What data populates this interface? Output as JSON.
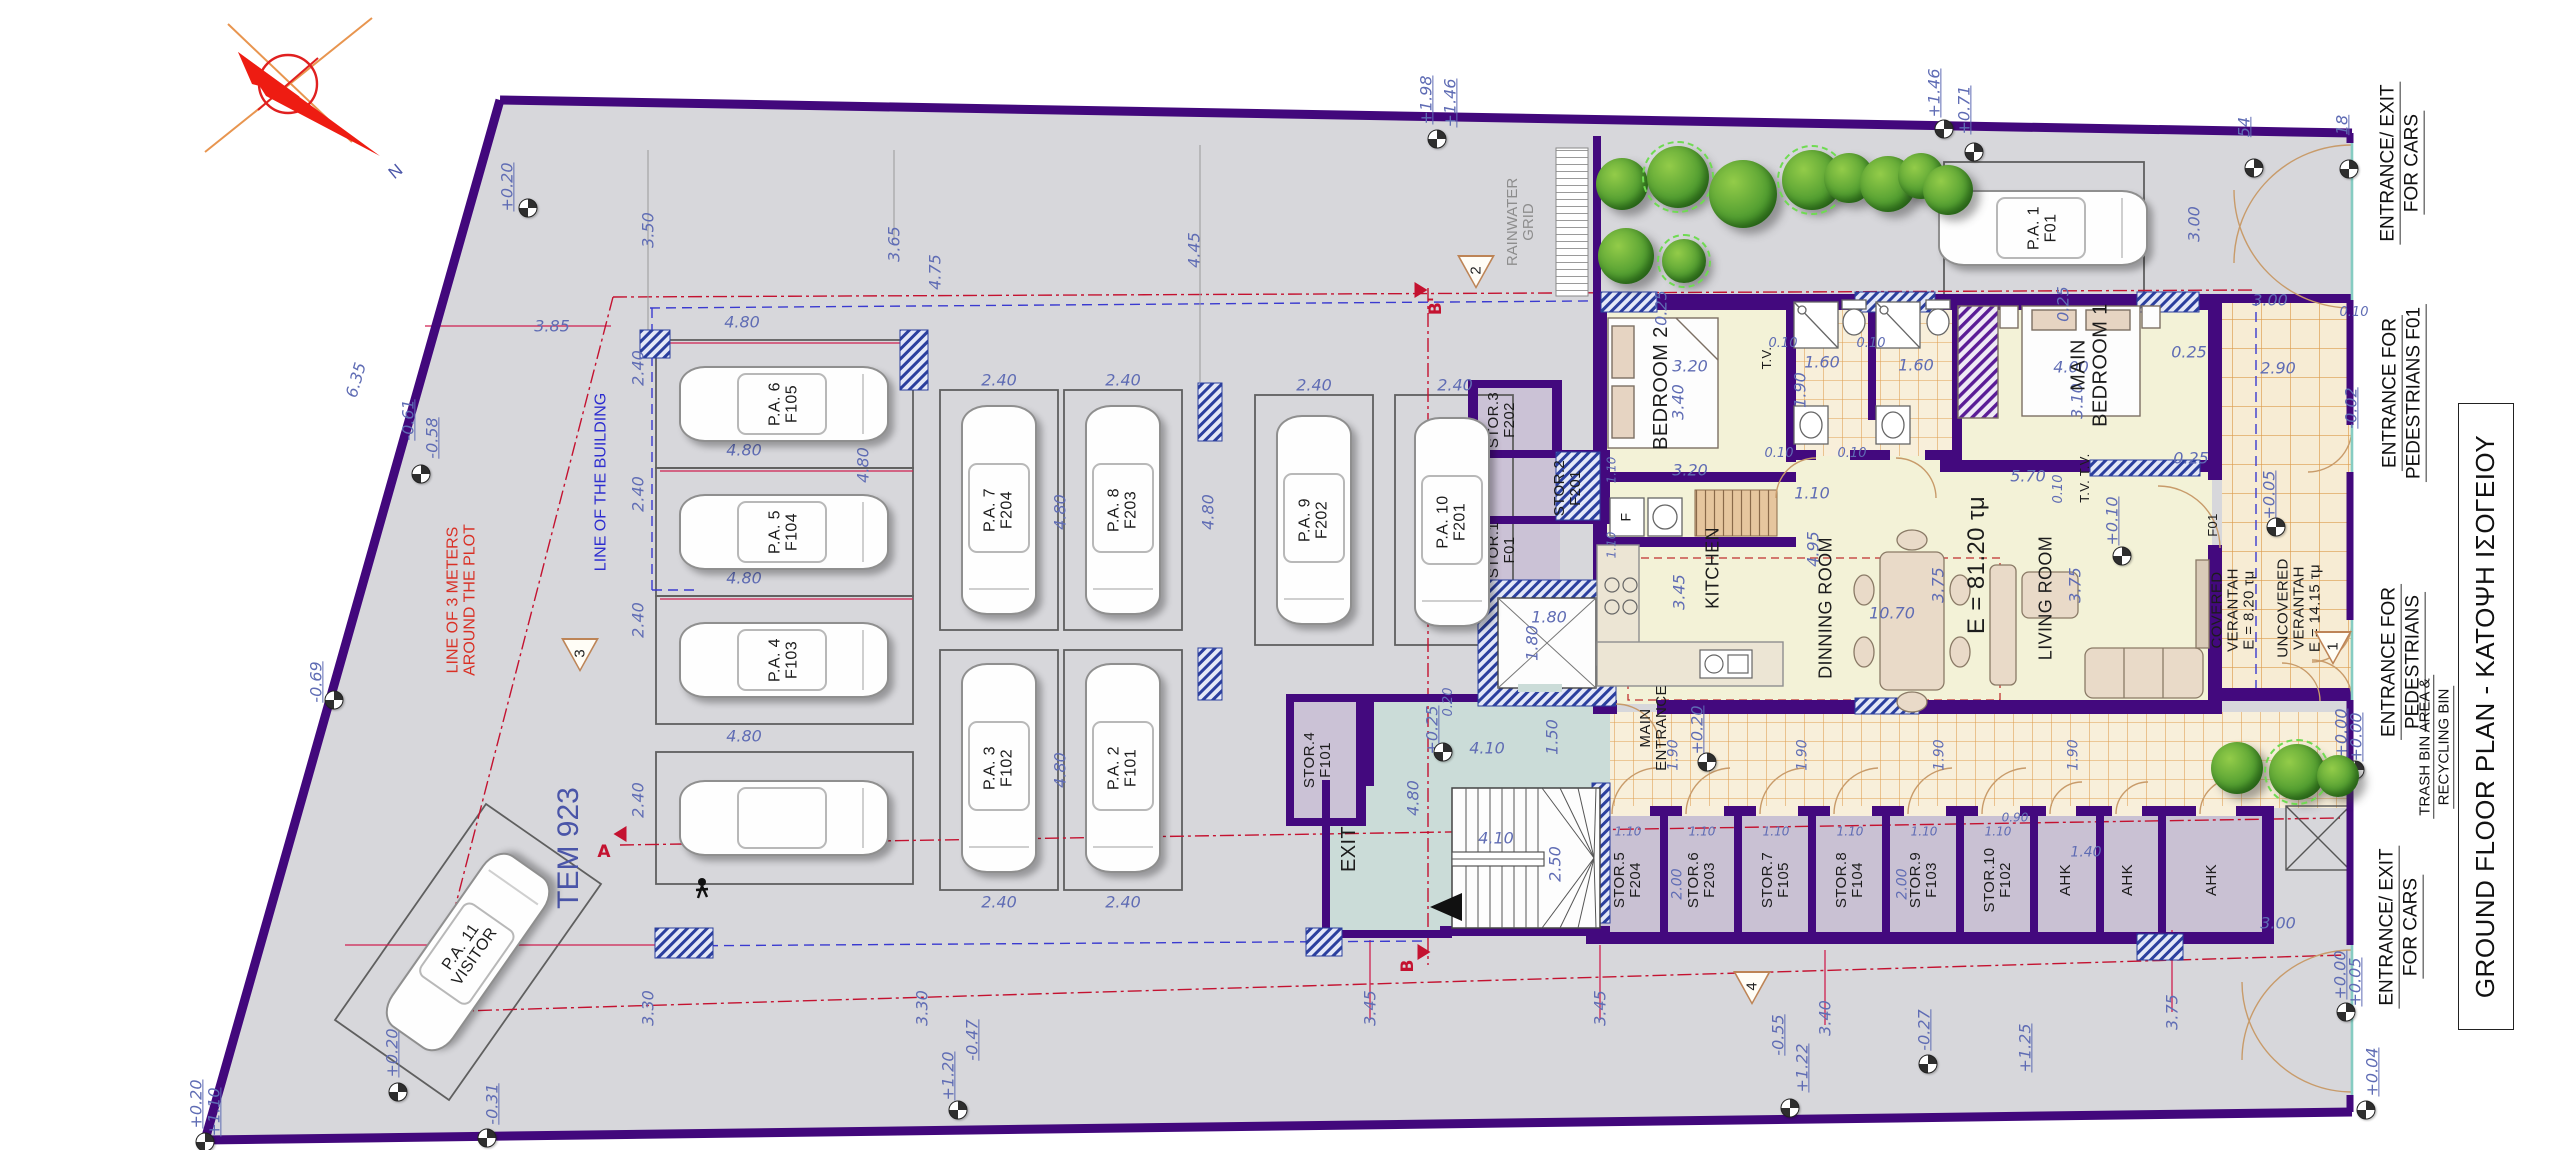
{
  "meta": {
    "title": "GROUND FLOOR PLAN - ΚΑΤΟΨΗ ΙΣΟΓΕΙΟΥ",
    "north_label": "N",
    "plot_id": "TEM 923"
  },
  "notes": {
    "plot_offset": "LINE OF 3 METERS\nAROUND THE PLOT",
    "building_line": "LINE OF THE BUILDING",
    "rainwater": "RAINWATER\nGRID"
  },
  "right_labels": [
    {
      "line1": "ENTRANCE/ EXIT",
      "line2": "FOR CARS"
    },
    {
      "line1": "ENTRANCE FOR",
      "line2": "PEDESTRIANS F01"
    },
    {
      "line1": "ENTRANCE FOR",
      "line2": "PEDESTRIANS"
    },
    {
      "line1": "TRASH BIN AREA &",
      "line2": "RECYCLING BIN"
    },
    {
      "line1": "ENTRANCE/ EXIT",
      "line2": "FOR CARS"
    }
  ],
  "rooms": [
    {
      "t": "BEDROOM 2",
      "x": 1662,
      "y": 388,
      "r": -90,
      "s": 20
    },
    {
      "t": "MAIN\nBEDROOM 1",
      "x": 2090,
      "y": 365,
      "r": -90,
      "s": 20
    },
    {
      "t": "KITCHEN",
      "x": 1713,
      "y": 568,
      "r": -90,
      "s": 18
    },
    {
      "t": "DINNING ROOM",
      "x": 1826,
      "y": 608,
      "r": -90,
      "s": 18
    },
    {
      "t": "LIVING ROOM",
      "x": 2046,
      "y": 598,
      "r": -90,
      "s": 18
    },
    {
      "t": "E = 81.20 τμ",
      "x": 1977,
      "y": 565,
      "r": -90,
      "s": 24
    },
    {
      "t": "MAIN\nENTRANCE",
      "x": 1654,
      "y": 728,
      "r": -90,
      "s": 15
    },
    {
      "t": "COVERED\nVERANTAH\nE = 8.20 τμ",
      "x": 2234,
      "y": 610,
      "r": -90,
      "s": 15
    },
    {
      "t": "UNCOVERED\nVERANTAH\nE = 14.15 τμ",
      "x": 2300,
      "y": 608,
      "r": -90,
      "s": 15
    },
    {
      "t": "T.V.",
      "x": 1767,
      "y": 358,
      "r": -90,
      "s": 13
    },
    {
      "t": "T.V. T.V.",
      "x": 2085,
      "y": 478,
      "r": -90,
      "s": 13
    },
    {
      "t": "F",
      "x": 1626,
      "y": 517,
      "r": -90,
      "s": 14
    },
    {
      "t": "F01",
      "x": 2213,
      "y": 525,
      "r": -90,
      "s": 13
    },
    {
      "t": "EXIT",
      "x": 1350,
      "y": 849,
      "r": -90,
      "s": 20
    }
  ],
  "storage": [
    {
      "t": "STOR.5\nF204",
      "x": 1628,
      "y": 880
    },
    {
      "t": "STOR.6\nF203",
      "x": 1702,
      "y": 880
    },
    {
      "t": "STOR.7\nF105",
      "x": 1776,
      "y": 880
    },
    {
      "t": "STOR.8\nF104",
      "x": 1850,
      "y": 880
    },
    {
      "t": "STOR.9\nF103",
      "x": 1924,
      "y": 880
    },
    {
      "t": "STOR.10\nF102",
      "x": 1998,
      "y": 880
    },
    {
      "t": "AHK",
      "x": 2066,
      "y": 880
    },
    {
      "t": "AHK",
      "x": 2128,
      "y": 880
    },
    {
      "t": "AHK",
      "x": 2212,
      "y": 880
    },
    {
      "t": "STOR.4\nF101",
      "x": 1318,
      "y": 760
    },
    {
      "t": "STOR.3\nF202",
      "x": 1502,
      "y": 420
    },
    {
      "t": "STOR.2\nF201",
      "x": 1568,
      "y": 488
    },
    {
      "t": "STOR.1\nF01",
      "x": 1502,
      "y": 550
    }
  ],
  "parking": [
    {
      "t": "P.A. 6\nF105",
      "cx": 784,
      "cy": 404,
      "o": "h"
    },
    {
      "t": "P.A. 5\nF104",
      "cx": 784,
      "cy": 532,
      "o": "h"
    },
    {
      "t": "P.A. 4\nF103",
      "cx": 784,
      "cy": 660,
      "o": "h"
    },
    {
      "t": "",
      "cx": 784,
      "cy": 818,
      "o": "h"
    },
    {
      "t": "P.A. 7\nF204",
      "cx": 999,
      "cy": 510,
      "o": "v"
    },
    {
      "t": "P.A. 8\nF203",
      "cx": 1123,
      "cy": 510,
      "o": "v"
    },
    {
      "t": "P.A. 3\nF102",
      "cx": 999,
      "cy": 768,
      "o": "v"
    },
    {
      "t": "P.A. 2\nF101",
      "cx": 1123,
      "cy": 768,
      "o": "v"
    },
    {
      "t": "P.A. 9\nF202",
      "cx": 1314,
      "cy": 520,
      "o": "v"
    },
    {
      "t": "P.A. 10\nF201",
      "cx": 1452,
      "cy": 522,
      "o": "v"
    },
    {
      "t": "P.A. 1\nF01",
      "cx": 2043,
      "cy": 228,
      "o": "h"
    },
    {
      "t": "P.A. 11\nVISITOR",
      "cx": 468,
      "cy": 952,
      "o": "h",
      "cr": -55,
      "lr": -55
    }
  ],
  "dimensions": [
    {
      "t": "3.50",
      "x": 648,
      "y": 230,
      "r": -90
    },
    {
      "t": "3.65",
      "x": 894,
      "y": 244,
      "r": -90
    },
    {
      "t": "4.75",
      "x": 935,
      "y": 272,
      "r": -90
    },
    {
      "t": "3.85",
      "x": 552,
      "y": 326,
      "r": 0
    },
    {
      "t": "4.45",
      "x": 1194,
      "y": 250,
      "r": -90
    },
    {
      "t": "6.35",
      "x": 356,
      "y": 380,
      "r": -74
    },
    {
      "t": "4.80",
      "x": 742,
      "y": 322,
      "r": 0
    },
    {
      "t": "4.80",
      "x": 744,
      "y": 450,
      "r": 0
    },
    {
      "t": "4.80",
      "x": 744,
      "y": 578,
      "r": 0
    },
    {
      "t": "4.80",
      "x": 744,
      "y": 736,
      "r": 0
    },
    {
      "t": "4.80",
      "x": 863,
      "y": 465,
      "r": -90
    },
    {
      "t": "2.40",
      "x": 638,
      "y": 368,
      "r": -90
    },
    {
      "t": "2.40",
      "x": 638,
      "y": 494,
      "r": -90
    },
    {
      "t": "2.40",
      "x": 638,
      "y": 620,
      "r": -90
    },
    {
      "t": "2.40",
      "x": 638,
      "y": 800,
      "r": -90
    },
    {
      "t": "2.40",
      "x": 999,
      "y": 380,
      "r": 0
    },
    {
      "t": "2.40",
      "x": 1123,
      "y": 380,
      "r": 0
    },
    {
      "t": "2.40",
      "x": 1314,
      "y": 385,
      "r": 0
    },
    {
      "t": "2.40",
      "x": 1455,
      "y": 385,
      "r": 0
    },
    {
      "t": "4.80",
      "x": 1060,
      "y": 512,
      "r": -90
    },
    {
      "t": "4.80",
      "x": 1208,
      "y": 512,
      "r": -90
    },
    {
      "t": "4.80",
      "x": 1332,
      "y": 512,
      "r": -90
    },
    {
      "t": "2.40",
      "x": 999,
      "y": 902,
      "r": 0
    },
    {
      "t": "2.40",
      "x": 1123,
      "y": 902,
      "r": 0
    },
    {
      "t": "4.80",
      "x": 1060,
      "y": 770,
      "r": -90
    },
    {
      "t": "7.50",
      "x": 460,
      "y": 945,
      "r": 0
    },
    {
      "t": "3.20",
      "x": 1690,
      "y": 366,
      "r": 0
    },
    {
      "t": "3.40",
      "x": 1678,
      "y": 402,
      "r": -90
    },
    {
      "t": "3.20",
      "x": 1690,
      "y": 470,
      "r": 0
    },
    {
      "t": "0.25",
      "x": 1661,
      "y": 308,
      "r": -90
    },
    {
      "t": "0.25",
      "x": 2063,
      "y": 304,
      "r": -90
    },
    {
      "t": "0.25",
      "x": 2189,
      "y": 352,
      "r": 0
    },
    {
      "t": "0.25",
      "x": 2191,
      "y": 458,
      "r": 0
    },
    {
      "t": "4.00",
      "x": 2071,
      "y": 367,
      "r": 0
    },
    {
      "t": "3.10",
      "x": 2077,
      "y": 401,
      "r": -90
    },
    {
      "t": "1.60",
      "x": 1822,
      "y": 362,
      "r": 0
    },
    {
      "t": "1.60",
      "x": 1916,
      "y": 365,
      "r": 0
    },
    {
      "t": "1.90",
      "x": 1800,
      "y": 390,
      "r": -90
    },
    {
      "t": "0.10",
      "x": 1783,
      "y": 344,
      "r": 0,
      "s": 13
    },
    {
      "t": "0.10",
      "x": 1871,
      "y": 344,
      "r": 0,
      "s": 13
    },
    {
      "t": "0.10",
      "x": 1779,
      "y": 454,
      "r": 0,
      "s": 13
    },
    {
      "t": "0.10",
      "x": 1852,
      "y": 454,
      "r": 0,
      "s": 13
    },
    {
      "t": "1.10",
      "x": 1812,
      "y": 493,
      "r": 0
    },
    {
      "t": "5.70",
      "x": 2028,
      "y": 476,
      "r": 0
    },
    {
      "t": "0.10",
      "x": 2059,
      "y": 489,
      "r": -90,
      "s": 13
    },
    {
      "t": "3.45",
      "x": 1679,
      "y": 592,
      "r": -90
    },
    {
      "t": "4.95",
      "x": 1813,
      "y": 549,
      "r": -90
    },
    {
      "t": "10.70",
      "x": 1892,
      "y": 613,
      "r": 0
    },
    {
      "t": "3.75",
      "x": 1938,
      "y": 585,
      "r": -90
    },
    {
      "t": "3.75",
      "x": 2075,
      "y": 585,
      "r": -90
    },
    {
      "t": "2.90",
      "x": 2278,
      "y": 368,
      "r": 0
    },
    {
      "t": "3.00",
      "x": 2270,
      "y": 300,
      "r": 0
    },
    {
      "t": "3.00",
      "x": 2194,
      "y": 224,
      "r": -90
    },
    {
      "t": "3.00",
      "x": 2278,
      "y": 923,
      "r": 0
    },
    {
      "t": "1.80",
      "x": 1549,
      "y": 617,
      "r": 0
    },
    {
      "t": "1.80",
      "x": 1532,
      "y": 643,
      "r": -90
    },
    {
      "t": "1.50",
      "x": 1552,
      "y": 737,
      "r": -90
    },
    {
      "t": "4.10",
      "x": 1487,
      "y": 748,
      "r": 0
    },
    {
      "t": "4.10",
      "x": 1496,
      "y": 838,
      "r": 0
    },
    {
      "t": "4.80",
      "x": 1413,
      "y": 798,
      "r": -90
    },
    {
      "t": "2.50",
      "x": 1555,
      "y": 864,
      "r": -90
    },
    {
      "t": "0.20",
      "x": 1449,
      "y": 702,
      "r": -90,
      "s": 13
    },
    {
      "t": "1.90",
      "x": 1674,
      "y": 755,
      "r": -90,
      "s": 14
    },
    {
      "t": "1.90",
      "x": 1803,
      "y": 755,
      "r": -90,
      "s": 14
    },
    {
      "t": "1.90",
      "x": 1940,
      "y": 755,
      "r": -90,
      "s": 14
    },
    {
      "t": "1.90",
      "x": 2074,
      "y": 755,
      "r": -90,
      "s": 14
    },
    {
      "t": "1.10",
      "x": 1628,
      "y": 832,
      "r": 0,
      "s": 12
    },
    {
      "t": "1.10",
      "x": 1702,
      "y": 832,
      "r": 0,
      "s": 12
    },
    {
      "t": "1.10",
      "x": 1776,
      "y": 832,
      "r": 0,
      "s": 12
    },
    {
      "t": "1.10",
      "x": 1850,
      "y": 832,
      "r": 0,
      "s": 12
    },
    {
      "t": "1.10",
      "x": 1924,
      "y": 832,
      "r": 0,
      "s": 12
    },
    {
      "t": "1.10",
      "x": 1998,
      "y": 832,
      "r": 0,
      "s": 12
    },
    {
      "t": "0.90",
      "x": 2015,
      "y": 818,
      "r": 0,
      "s": 12
    },
    {
      "t": "1.40",
      "x": 2086,
      "y": 853,
      "r": 0,
      "s": 14
    },
    {
      "t": "2.00",
      "x": 1678,
      "y": 884,
      "r": -90,
      "s": 14
    },
    {
      "t": "2.00",
      "x": 1903,
      "y": 884,
      "r": -90,
      "s": 14
    },
    {
      "t": "1.10",
      "x": 1612,
      "y": 470,
      "r": -90,
      "s": 12
    },
    {
      "t": "1.10",
      "x": 1612,
      "y": 545,
      "r": -90,
      "s": 12
    },
    {
      "t": "0.10",
      "x": 2354,
      "y": 313,
      "r": 0,
      "s": 13
    },
    {
      "t": "3.30",
      "x": 648,
      "y": 1008,
      "r": -90
    },
    {
      "t": "3.30",
      "x": 922,
      "y": 1008,
      "r": -90
    },
    {
      "t": "3.45",
      "x": 1370,
      "y": 1008,
      "r": -90
    },
    {
      "t": "3.45",
      "x": 1600,
      "y": 1008,
      "r": -90
    },
    {
      "t": "3.40",
      "x": 1825,
      "y": 1018,
      "r": -90
    },
    {
      "t": "3.75",
      "x": 2172,
      "y": 1012,
      "r": -90
    }
  ],
  "elevations": [
    {
      "t": "+0.20",
      "x": 507,
      "y": 187,
      "r": -90,
      "cx": 528,
      "cy": 208
    },
    {
      "t": "-0.61",
      "x": 408,
      "y": 420,
      "r": -90
    },
    {
      "t": "-0.58",
      "x": 432,
      "y": 438,
      "r": -90,
      "cx": 421,
      "cy": 474
    },
    {
      "t": "-0.69",
      "x": 316,
      "y": 682,
      "r": -90,
      "cx": 334,
      "cy": 700
    },
    {
      "t": "+1.98",
      "x": 1426,
      "y": 100,
      "r": -90
    },
    {
      "t": "+1.46",
      "x": 1450,
      "y": 103,
      "r": -90,
      "cx": 1437,
      "cy": 139
    },
    {
      "t": "+1.46",
      "x": 1934,
      "y": 93,
      "r": -90,
      "cx": 1944,
      "cy": 129
    },
    {
      "t": "+0.71",
      "x": 1964,
      "y": 110,
      "r": -90,
      "cx": 1974,
      "cy": 152
    },
    {
      "t": "54",
      "x": 2244,
      "y": 127,
      "r": -90,
      "cx": 2254,
      "cy": 168
    },
    {
      "t": "18",
      "x": 2342,
      "y": 125,
      "r": -90,
      "cx": 2349,
      "cy": 169
    },
    {
      "t": "+0.25",
      "x": 1432,
      "y": 730,
      "r": -90,
      "cx": 1443,
      "cy": 752
    },
    {
      "t": "+0.20",
      "x": 1697,
      "y": 730,
      "r": -90,
      "cx": 1707,
      "cy": 762
    },
    {
      "t": "+0.10",
      "x": 2112,
      "y": 521,
      "r": -90,
      "cx": 2122,
      "cy": 556
    },
    {
      "t": "+0.05",
      "x": 2269,
      "y": 495,
      "r": -90,
      "cx": 2276,
      "cy": 527
    },
    {
      "t": "-0.02",
      "x": 2351,
      "y": 408,
      "r": -90
    },
    {
      "t": "+0.20",
      "x": 392,
      "y": 1053,
      "r": -90,
      "cx": 398,
      "cy": 1092
    },
    {
      "t": "-0.31",
      "x": 492,
      "y": 1104,
      "r": -90,
      "cx": 487,
      "cy": 1138
    },
    {
      "t": "+0.20",
      "x": 196,
      "y": 1104,
      "r": -90,
      "cx": 205,
      "cy": 1142
    },
    {
      "t": "+1.10",
      "x": 214,
      "y": 1112,
      "r": -90
    },
    {
      "t": "-0.47",
      "x": 972,
      "y": 1040,
      "r": -90,
      "cx": 958,
      "cy": 1110
    },
    {
      "t": "+1.20",
      "x": 948,
      "y": 1076,
      "r": -90
    },
    {
      "t": "-0.55",
      "x": 1778,
      "y": 1035,
      "r": -90,
      "cx": 1790,
      "cy": 1108
    },
    {
      "t": "+1.22",
      "x": 1802,
      "y": 1068,
      "r": -90
    },
    {
      "t": "-0.27",
      "x": 1924,
      "y": 1030,
      "r": -90,
      "cx": 1928,
      "cy": 1064
    },
    {
      "t": "+1.25",
      "x": 2025,
      "y": 1048,
      "r": -90
    },
    {
      "t": "+0.00",
      "x": 2341,
      "y": 733,
      "r": -90,
      "cx": 2355,
      "cy": 770
    },
    {
      "t": "+0.00",
      "x": 2356,
      "y": 737,
      "r": -90
    },
    {
      "t": "+0.00",
      "x": 2340,
      "y": 975,
      "r": -90,
      "cx": 2346,
      "cy": 1012
    },
    {
      "t": "+0.05",
      "x": 2355,
      "y": 982,
      "r": -90
    },
    {
      "t": "+0.04",
      "x": 2372,
      "y": 1072,
      "r": -90,
      "cx": 2366,
      "cy": 1110
    }
  ],
  "markers": [
    {
      "n": "1",
      "x": 2333,
      "y": 648
    },
    {
      "n": "2",
      "x": 1476,
      "y": 272
    },
    {
      "n": "3",
      "x": 580,
      "y": 655
    },
    {
      "n": "4",
      "x": 1752,
      "y": 988
    }
  ],
  "sections": [
    {
      "t": "B'",
      "x": 1436,
      "y": 306,
      "r": -90,
      "fx": 1421,
      "fy": 290,
      "fr": 0
    },
    {
      "t": "B",
      "x": 1408,
      "y": 966,
      "r": -90,
      "fx": 1424,
      "fy": 952,
      "fr": 0
    },
    {
      "t": "A",
      "x": 604,
      "y": 852,
      "r": 0,
      "fx": 620,
      "fy": 834,
      "fr": 180
    }
  ],
  "trees": [
    {
      "x": 1622,
      "y": 184,
      "d": 52
    },
    {
      "x": 1678,
      "y": 177,
      "d": 62,
      "ring": true
    },
    {
      "x": 1743,
      "y": 194,
      "d": 68
    },
    {
      "x": 1812,
      "y": 180,
      "d": 60,
      "ring": true
    },
    {
      "x": 1849,
      "y": 178,
      "d": 50
    },
    {
      "x": 1888,
      "y": 184,
      "d": 56
    },
    {
      "x": 1921,
      "y": 176,
      "d": 46
    },
    {
      "x": 1948,
      "y": 190,
      "d": 50
    },
    {
      "x": 1626,
      "y": 256,
      "d": 56
    },
    {
      "x": 1684,
      "y": 261,
      "d": 44,
      "ring": true
    },
    {
      "x": 2237,
      "y": 768,
      "d": 52
    },
    {
      "x": 2297,
      "y": 772,
      "d": 56,
      "ring": true
    },
    {
      "x": 2338,
      "y": 776,
      "d": 42
    }
  ]
}
